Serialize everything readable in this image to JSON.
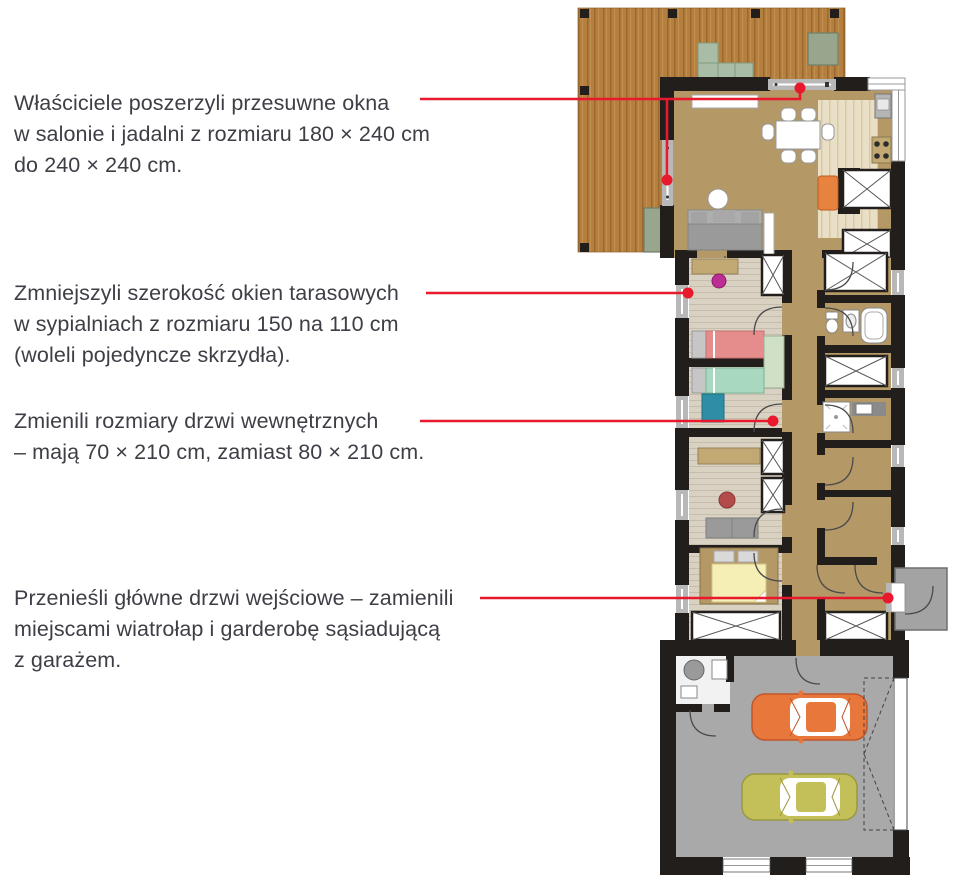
{
  "figure": {
    "kind": "annotated-floor-plan",
    "language": "pl"
  },
  "annotations": [
    {
      "id": "sliding-windows-salon",
      "lines": [
        "Właściciele poszerzyli przesuwne okna",
        "w salonie i jadalni z rozmiaru 180 × 240 cm",
        "do 240 × 240 cm."
      ]
    },
    {
      "id": "terrace-windows-bedrooms",
      "lines": [
        "Zmniejszyli szerokość okien tarasowych",
        "w sypialniach z rozmiaru 150 na 110 cm",
        "(woleli pojedyncze skrzydła)."
      ]
    },
    {
      "id": "internal-doors",
      "lines": [
        "Zmienili rozmiary drzwi wewnętrznych",
        "– mają 70 × 210 cm, zamiast 80 × 210 cm."
      ]
    },
    {
      "id": "main-entrance",
      "lines": [
        "Przenieśli główne drzwi wejściowe – zamienili",
        "miejscami wiatrołap i garderobę sąsiadującą",
        "z garażem."
      ]
    }
  ],
  "colors": {
    "callout": "#e8192c",
    "text": "#3e3e46",
    "wall": "#221e1c",
    "deck_wood": "#b5803f",
    "wood_grain": "#9c6a30",
    "wood_grain_light": "#c3904f",
    "floor_main": "#b49866",
    "floor_light": "#e9dfc6",
    "floor_stripe": "#d6c9a4",
    "floor_bedroom": "#d9d2c3",
    "bedroom_stripe": "#c6bdac",
    "garage_floor": "#a9a9a9",
    "porch": "#a3a3a3",
    "window_gray": "#b8b8b8",
    "car_orange": "#e8773c",
    "car_orange_dark": "#c2562a",
    "car_green": "#c3c05a",
    "car_green_dark": "#9a9840",
    "bed_pink": "#e58c8c",
    "bed_green": "#a8d8bf",
    "bed_yellow": "#f5efb6",
    "sofa_gray": "#9a9a9a",
    "armchair_orange": "#e8823f",
    "desk_teal": "#2e8ea6",
    "chair_magenta": "#bc2e94",
    "outdoor_furniture": "#a9bda6",
    "desk_wood": "#c2a873"
  }
}
